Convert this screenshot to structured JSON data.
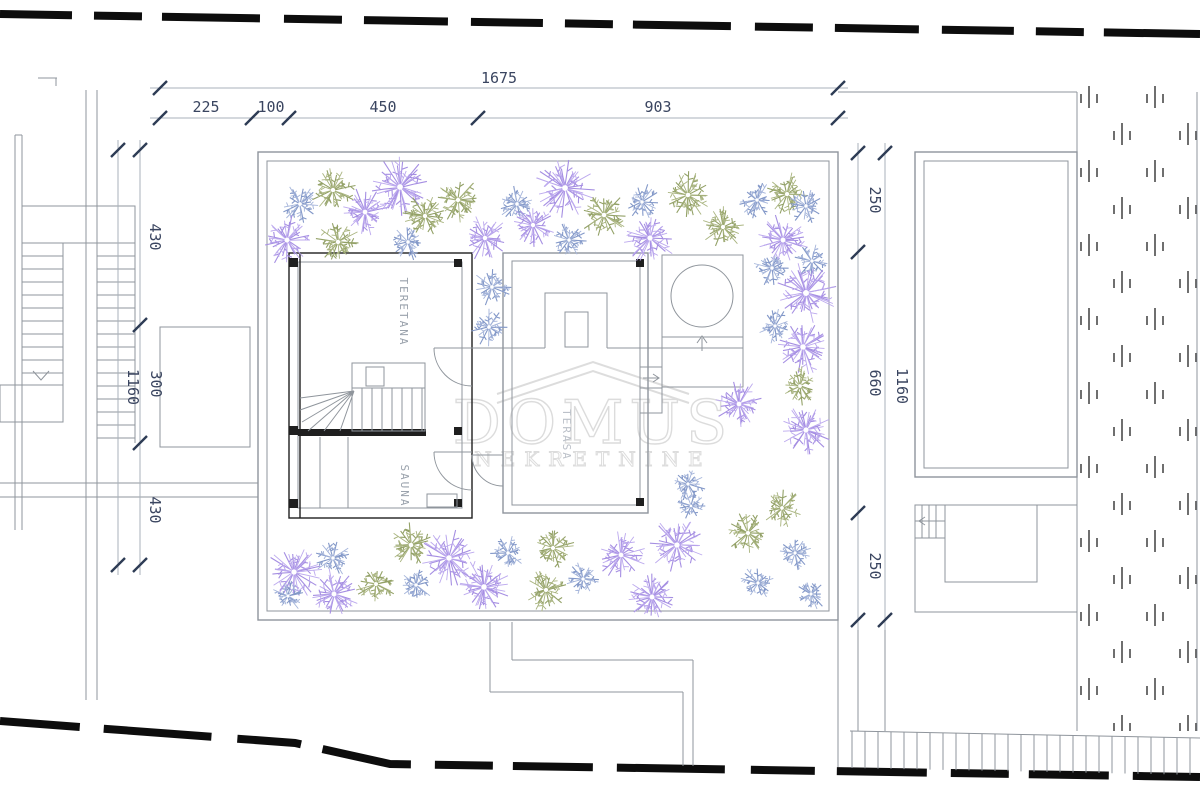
{
  "watermark": {
    "title": "DOMUS",
    "subtitle": "NEKRETNINE"
  },
  "rooms": {
    "teretana": "TERETANA",
    "sauna": "SAUNA",
    "terasa": "TERASA"
  },
  "dimensions": {
    "top_total": {
      "label": "1675"
    },
    "top_segments": [
      {
        "label": "225"
      },
      {
        "label": "100"
      },
      {
        "label": "450"
      },
      {
        "label": "903"
      }
    ],
    "left_total": {
      "label": "1160"
    },
    "left_segments": [
      {
        "label": "430"
      },
      {
        "label": "300"
      },
      {
        "label": "430"
      }
    ],
    "right_total": {
      "label": "1160"
    },
    "right_segments": [
      {
        "label": "250"
      },
      {
        "label": "660"
      },
      {
        "label": "250"
      }
    ]
  },
  "colors": {
    "boundary": "#0d0d0d",
    "plan_line": "#8f959c",
    "plan_dark": "#1f1f1f",
    "dimension_tick": "#2e3c55",
    "dimension_line": "#aab1bb",
    "dimension_text": "#3a4560",
    "room_label": "#9aa2ac",
    "room_label_light": "#bcc1c9",
    "watermark": "#d7d7d7",
    "hatch": "#3f3f3f",
    "plants": {
      "purple": [
        "#a58ee2",
        "#bca9ee"
      ],
      "blue": [
        "#8398c8",
        "#a4b4da"
      ],
      "olive": [
        "#93a167",
        "#a9b47f"
      ]
    }
  },
  "plants": [
    {
      "x": 300,
      "y": 204,
      "r": 19,
      "type": "blue"
    },
    {
      "x": 333,
      "y": 190,
      "r": 22,
      "type": "olive"
    },
    {
      "x": 365,
      "y": 212,
      "r": 24,
      "type": "purple"
    },
    {
      "x": 400,
      "y": 187,
      "r": 29,
      "type": "purple"
    },
    {
      "x": 287,
      "y": 240,
      "r": 25,
      "type": "purple"
    },
    {
      "x": 338,
      "y": 242,
      "r": 22,
      "type": "olive"
    },
    {
      "x": 425,
      "y": 216,
      "r": 22,
      "type": "olive"
    },
    {
      "x": 458,
      "y": 200,
      "r": 22,
      "type": "olive"
    },
    {
      "x": 408,
      "y": 242,
      "r": 18,
      "type": "blue"
    },
    {
      "x": 485,
      "y": 238,
      "r": 23,
      "type": "purple"
    },
    {
      "x": 517,
      "y": 204,
      "r": 19,
      "type": "blue"
    },
    {
      "x": 533,
      "y": 225,
      "r": 22,
      "type": "purple"
    },
    {
      "x": 565,
      "y": 188,
      "r": 29,
      "type": "purple"
    },
    {
      "x": 569,
      "y": 240,
      "r": 18,
      "type": "blue"
    },
    {
      "x": 604,
      "y": 215,
      "r": 23,
      "type": "olive"
    },
    {
      "x": 642,
      "y": 202,
      "r": 18,
      "type": "blue"
    },
    {
      "x": 650,
      "y": 238,
      "r": 26,
      "type": "purple"
    },
    {
      "x": 688,
      "y": 195,
      "r": 23,
      "type": "olive"
    },
    {
      "x": 723,
      "y": 227,
      "r": 21,
      "type": "olive"
    },
    {
      "x": 757,
      "y": 200,
      "r": 18,
      "type": "blue"
    },
    {
      "x": 787,
      "y": 194,
      "r": 21,
      "type": "olive"
    },
    {
      "x": 783,
      "y": 240,
      "r": 25,
      "type": "purple"
    },
    {
      "x": 806,
      "y": 206,
      "r": 18,
      "type": "blue"
    },
    {
      "x": 492,
      "y": 287,
      "r": 19,
      "type": "blue"
    },
    {
      "x": 489,
      "y": 327,
      "r": 19,
      "type": "blue"
    },
    {
      "x": 772,
      "y": 268,
      "r": 18,
      "type": "blue"
    },
    {
      "x": 812,
      "y": 261,
      "r": 17,
      "type": "blue"
    },
    {
      "x": 806,
      "y": 293,
      "r": 30,
      "type": "purple"
    },
    {
      "x": 775,
      "y": 326,
      "r": 17,
      "type": "blue"
    },
    {
      "x": 803,
      "y": 347,
      "r": 28,
      "type": "purple"
    },
    {
      "x": 800,
      "y": 386,
      "r": 19,
      "type": "olive"
    },
    {
      "x": 739,
      "y": 404,
      "r": 24,
      "type": "purple"
    },
    {
      "x": 806,
      "y": 430,
      "r": 26,
      "type": "purple"
    },
    {
      "x": 688,
      "y": 484,
      "r": 17,
      "type": "blue"
    },
    {
      "x": 294,
      "y": 572,
      "r": 27,
      "type": "purple"
    },
    {
      "x": 288,
      "y": 596,
      "r": 16,
      "type": "blue"
    },
    {
      "x": 333,
      "y": 558,
      "r": 18,
      "type": "blue"
    },
    {
      "x": 334,
      "y": 594,
      "r": 25,
      "type": "purple"
    },
    {
      "x": 376,
      "y": 584,
      "r": 20,
      "type": "olive"
    },
    {
      "x": 411,
      "y": 545,
      "r": 23,
      "type": "olive"
    },
    {
      "x": 416,
      "y": 585,
      "r": 18,
      "type": "blue"
    },
    {
      "x": 449,
      "y": 558,
      "r": 28,
      "type": "purple"
    },
    {
      "x": 484,
      "y": 587,
      "r": 28,
      "type": "purple"
    },
    {
      "x": 508,
      "y": 553,
      "r": 18,
      "type": "blue"
    },
    {
      "x": 553,
      "y": 548,
      "r": 21,
      "type": "olive"
    },
    {
      "x": 546,
      "y": 590,
      "r": 21,
      "type": "olive"
    },
    {
      "x": 583,
      "y": 579,
      "r": 17,
      "type": "blue"
    },
    {
      "x": 621,
      "y": 555,
      "r": 24,
      "type": "purple"
    },
    {
      "x": 652,
      "y": 597,
      "r": 25,
      "type": "purple"
    },
    {
      "x": 677,
      "y": 545,
      "r": 27,
      "type": "purple"
    },
    {
      "x": 748,
      "y": 533,
      "r": 21,
      "type": "olive"
    },
    {
      "x": 758,
      "y": 583,
      "r": 17,
      "type": "blue"
    },
    {
      "x": 795,
      "y": 553,
      "r": 17,
      "type": "blue"
    },
    {
      "x": 811,
      "y": 594,
      "r": 16,
      "type": "blue"
    },
    {
      "x": 782,
      "y": 508,
      "r": 19,
      "type": "olive"
    },
    {
      "x": 691,
      "y": 506,
      "r": 14,
      "type": "blue"
    }
  ]
}
